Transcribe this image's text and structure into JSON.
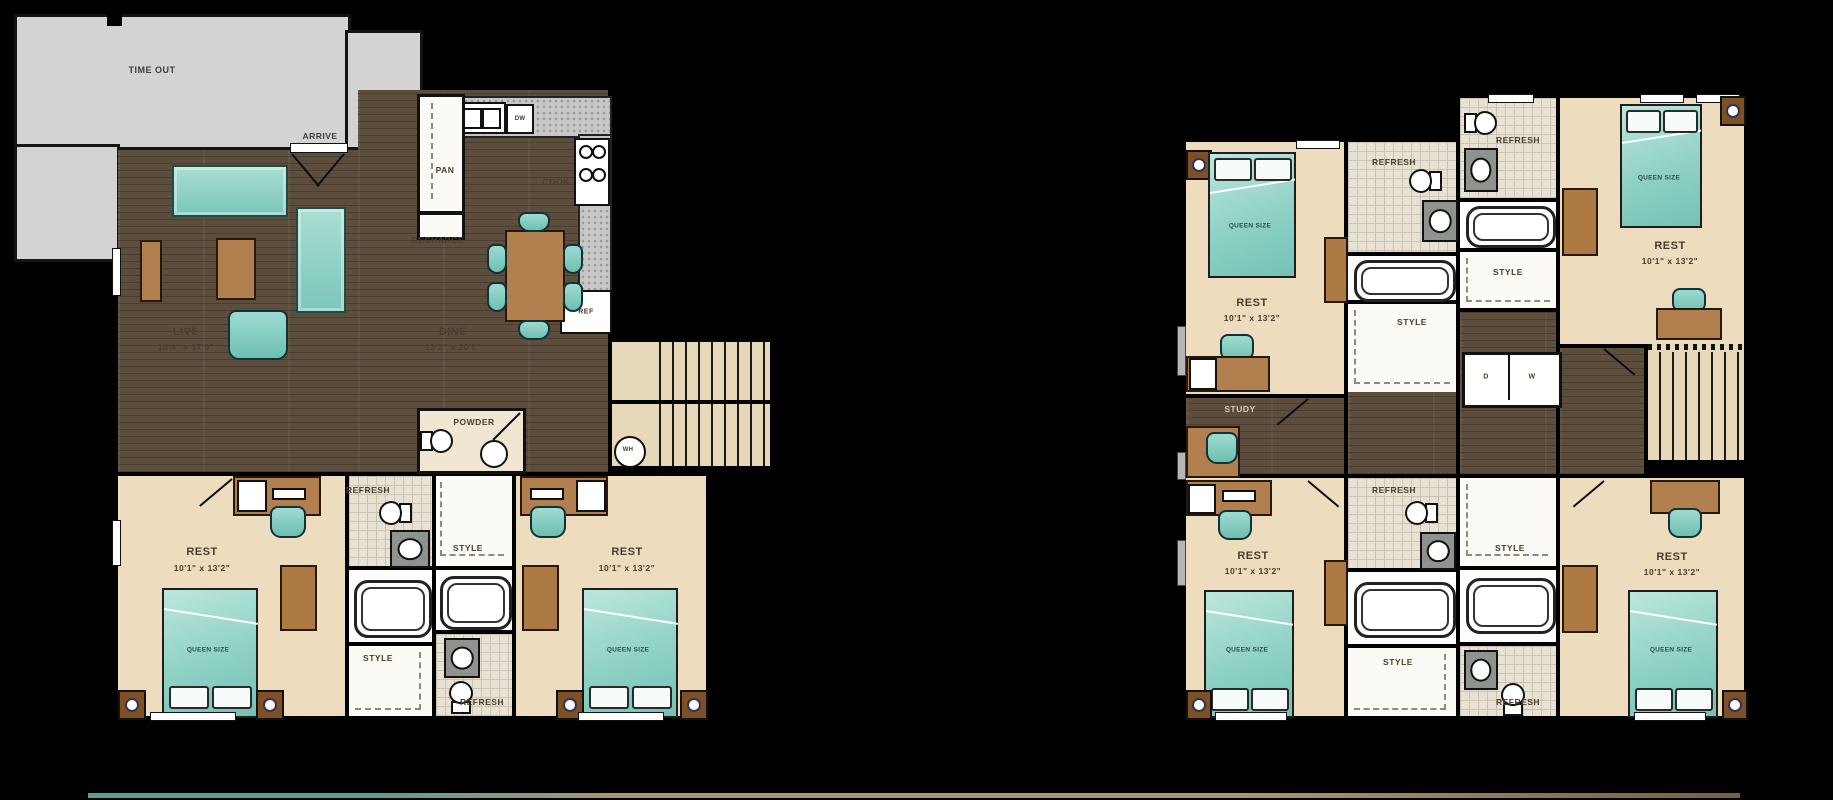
{
  "palette": {
    "background": "#000000",
    "wood_floor": "#5d4d3d",
    "bedroom_floor": "#eedcbf",
    "tile_floor": "#e7e2d3",
    "patio_gray": "#d3d3d1",
    "stairs_tan": "#e8d8ba",
    "furniture_wood": "#b1804e",
    "upholstery_teal": "#8ed0c5",
    "wall": "#141414",
    "label_text": "#4a3c2c"
  },
  "floor1": {
    "patio_label": "TIME OUT",
    "arrive": "ARRIVE",
    "pantry": "PAN",
    "recharge": "RECHARGE",
    "cook": "COOK",
    "dishwasher": "DW",
    "refrigerator": "REF",
    "live": {
      "name": "LIVE",
      "dims": "15'4\" x 17'9\""
    },
    "dine": {
      "name": "DINE",
      "dims": "13'2\" x 20'5\""
    },
    "powder": "POWDER",
    "water_heater": "WH",
    "bedroom_left": {
      "name": "REST",
      "dims": "10'1\" x 13'2\"",
      "bed": "QUEEN SIZE"
    },
    "bedroom_right": {
      "name": "REST",
      "dims": "10'1\" x 13'2\"",
      "bed": "QUEEN SIZE"
    },
    "bath_top": "REFRESH",
    "bath_bottom": "REFRESH",
    "closet_top": "STYLE",
    "closet_bottom": "STYLE"
  },
  "floor2": {
    "study": "STUDY",
    "dryer": "D",
    "washer": "W",
    "bedroom_tl": {
      "name": "REST",
      "dims": "10'1\" x 13'2\"",
      "bed": "QUEEN SIZE"
    },
    "bedroom_tr": {
      "name": "REST",
      "dims": "10'1\" x 13'2\"",
      "bed": "QUEEN SIZE"
    },
    "bedroom_bl": {
      "name": "REST",
      "dims": "10'1\" x 13'2\"",
      "bed": "QUEEN SIZE"
    },
    "bedroom_br": {
      "name": "REST",
      "dims": "10'1\" x 13'2\"",
      "bed": "QUEEN SIZE"
    },
    "bath_tl": "REFRESH",
    "bath_tr": "REFRESH",
    "bath_bl": "REFRESH",
    "bath_br": "REFRESH",
    "closet_tl": "STYLE",
    "closet_tr": "STYLE",
    "closet_bl": "STYLE",
    "closet_br": "STYLE"
  }
}
